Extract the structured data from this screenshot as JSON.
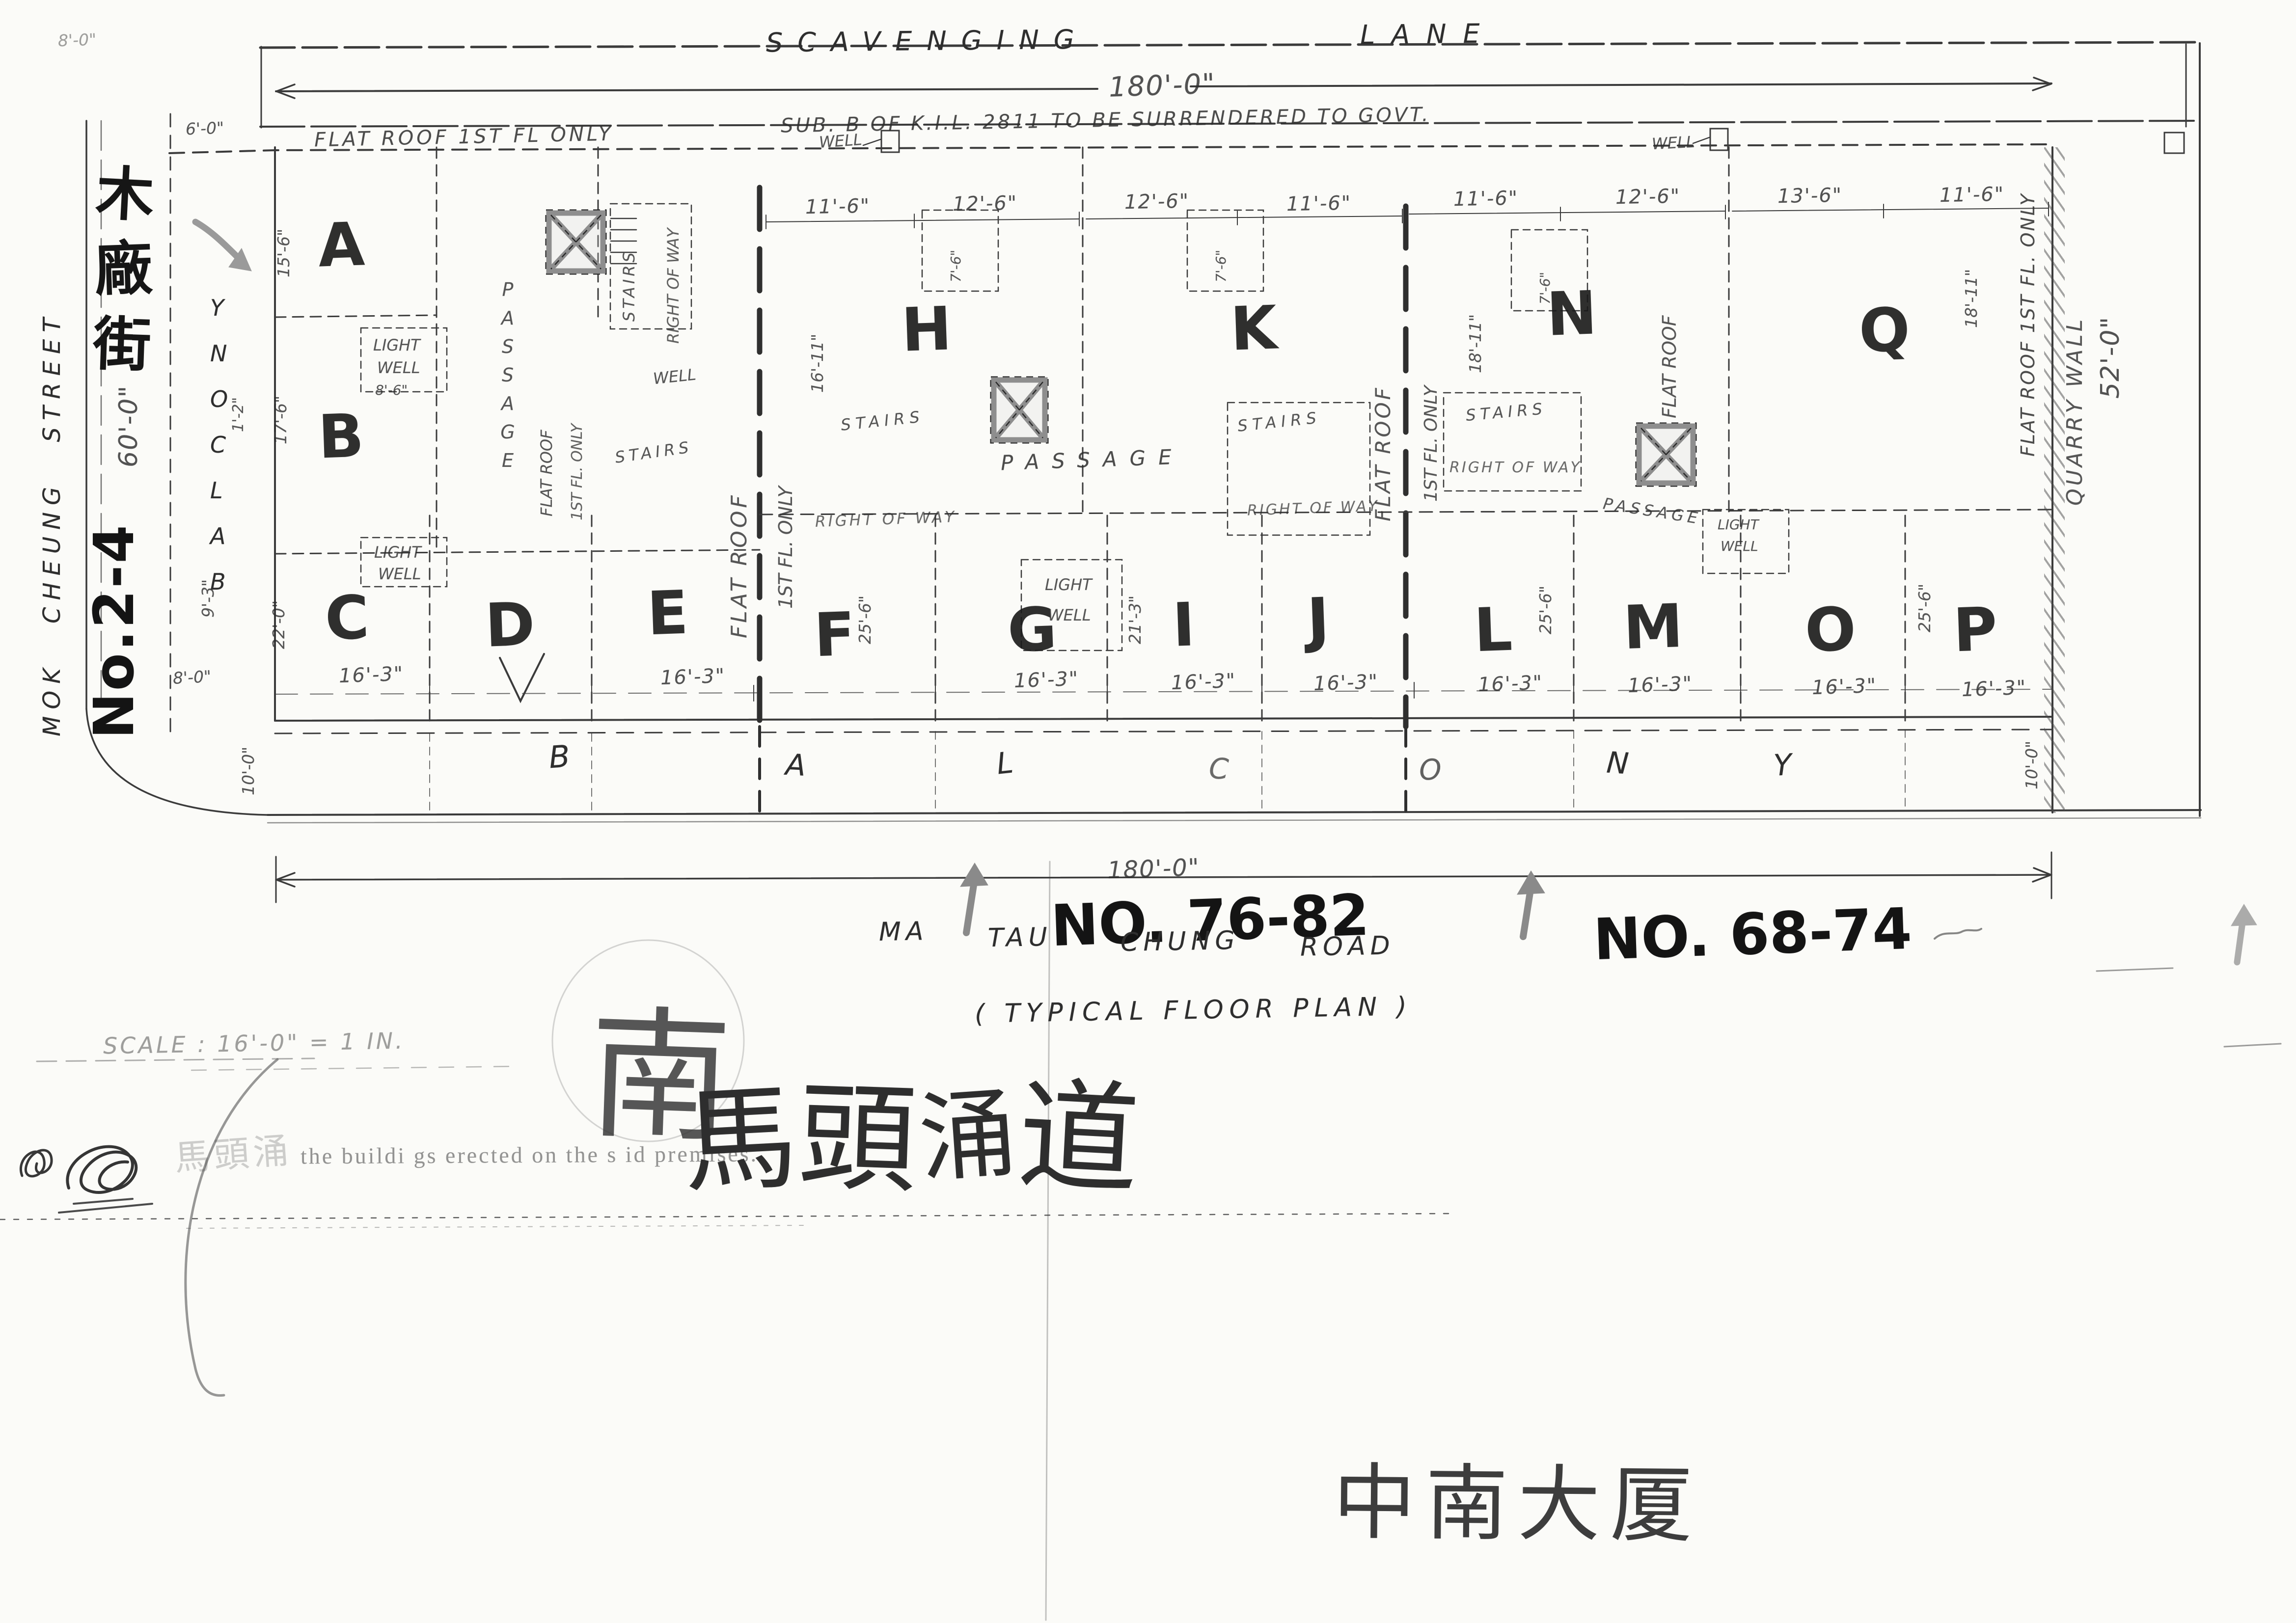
{
  "top": {
    "lane_word1": "SCAVENGING",
    "lane_word2": "LANE",
    "dim": "180'-0\"",
    "surrender": "SUB. B OF K.I.L. 2811 TO BE SURRENDERED TO GOVT.",
    "flat_roof_note": "FLAT ROOF 1ST FL ONLY",
    "well": "WELL"
  },
  "left": {
    "street": "MOK  CHEUNG  STREET",
    "street_cn": [
      "木",
      "廠",
      "街"
    ],
    "building_no": "No.2-4",
    "dim_60": "60'-0\"",
    "dim_6": "6'-0\"",
    "corner_dim": "8'-0\"",
    "street_dim": "8'-0\"",
    "dim_1_2": "1'-2\"",
    "dim_9_3": "9'-3\"",
    "dim_10": "10'-0\"",
    "balcony": [
      "B",
      "A",
      "L",
      "C",
      "O",
      "N",
      "Y"
    ]
  },
  "right": {
    "quarry": "QUARRY WALL",
    "dim_52": "52'-0\"",
    "dim_10": "10'-0\"",
    "flat_roof_edge": "FLAT ROOF 1ST FL. ONLY",
    "dim_18_11": "18'-11\""
  },
  "flats": {
    "a": "A",
    "b": "B",
    "c": "C",
    "d": "D",
    "e": "E",
    "f": "F",
    "g": "G",
    "h": "H",
    "i": "I",
    "j": "J",
    "k": "K",
    "l": "L",
    "m": "M",
    "n": "N",
    "o": "O",
    "p": "P",
    "q": "Q"
  },
  "labels": {
    "stairs": "STAIRS",
    "right_of_way": "RIGHT OF WAY",
    "passage": "PASSAGE",
    "light": "LIGHT",
    "well": "WELL",
    "flat_roof": "FLAT ROOF",
    "first_floor_only": "1ST FL. ONLY",
    "dim_8_6": "8'-6\""
  },
  "dims": {
    "d11_6": "11'-6\"",
    "d12_6": "12'-6\"",
    "d13_6": "13'-6\"",
    "d7_6": "7'-6\"",
    "d16_11": "16'-11\"",
    "d18_11": "18'-11\"",
    "d15_6": "15'-6\"",
    "d17_6": "17'-6\"",
    "d22_0": "22'-0\"",
    "d25_6": "25'-6\"",
    "d21_3": "21'-3\"",
    "d16_3": "16'-3\""
  },
  "bottom": {
    "dim": "180'-0\"",
    "no_76_82": "NO. 76-82",
    "road_words": [
      "MA",
      "TAU",
      "CHUNG",
      "ROAD"
    ],
    "typical": "( TYPICAL FLOOR PLAN )",
    "no_68_74": "NO. 68-74",
    "scale": "SCALE : 16'-0\" = 1 IN.",
    "south_cn": "南",
    "road_cn": [
      "馬",
      "頭",
      "涌",
      "道"
    ],
    "premises": "the buildi gs  erected on  the s id premises.",
    "faint_cn": "馬頭涌",
    "building_name_cn": "中南大厦",
    "balcony_row": [
      "B",
      "A",
      "L",
      "C",
      "O",
      "N",
      "Y"
    ]
  }
}
